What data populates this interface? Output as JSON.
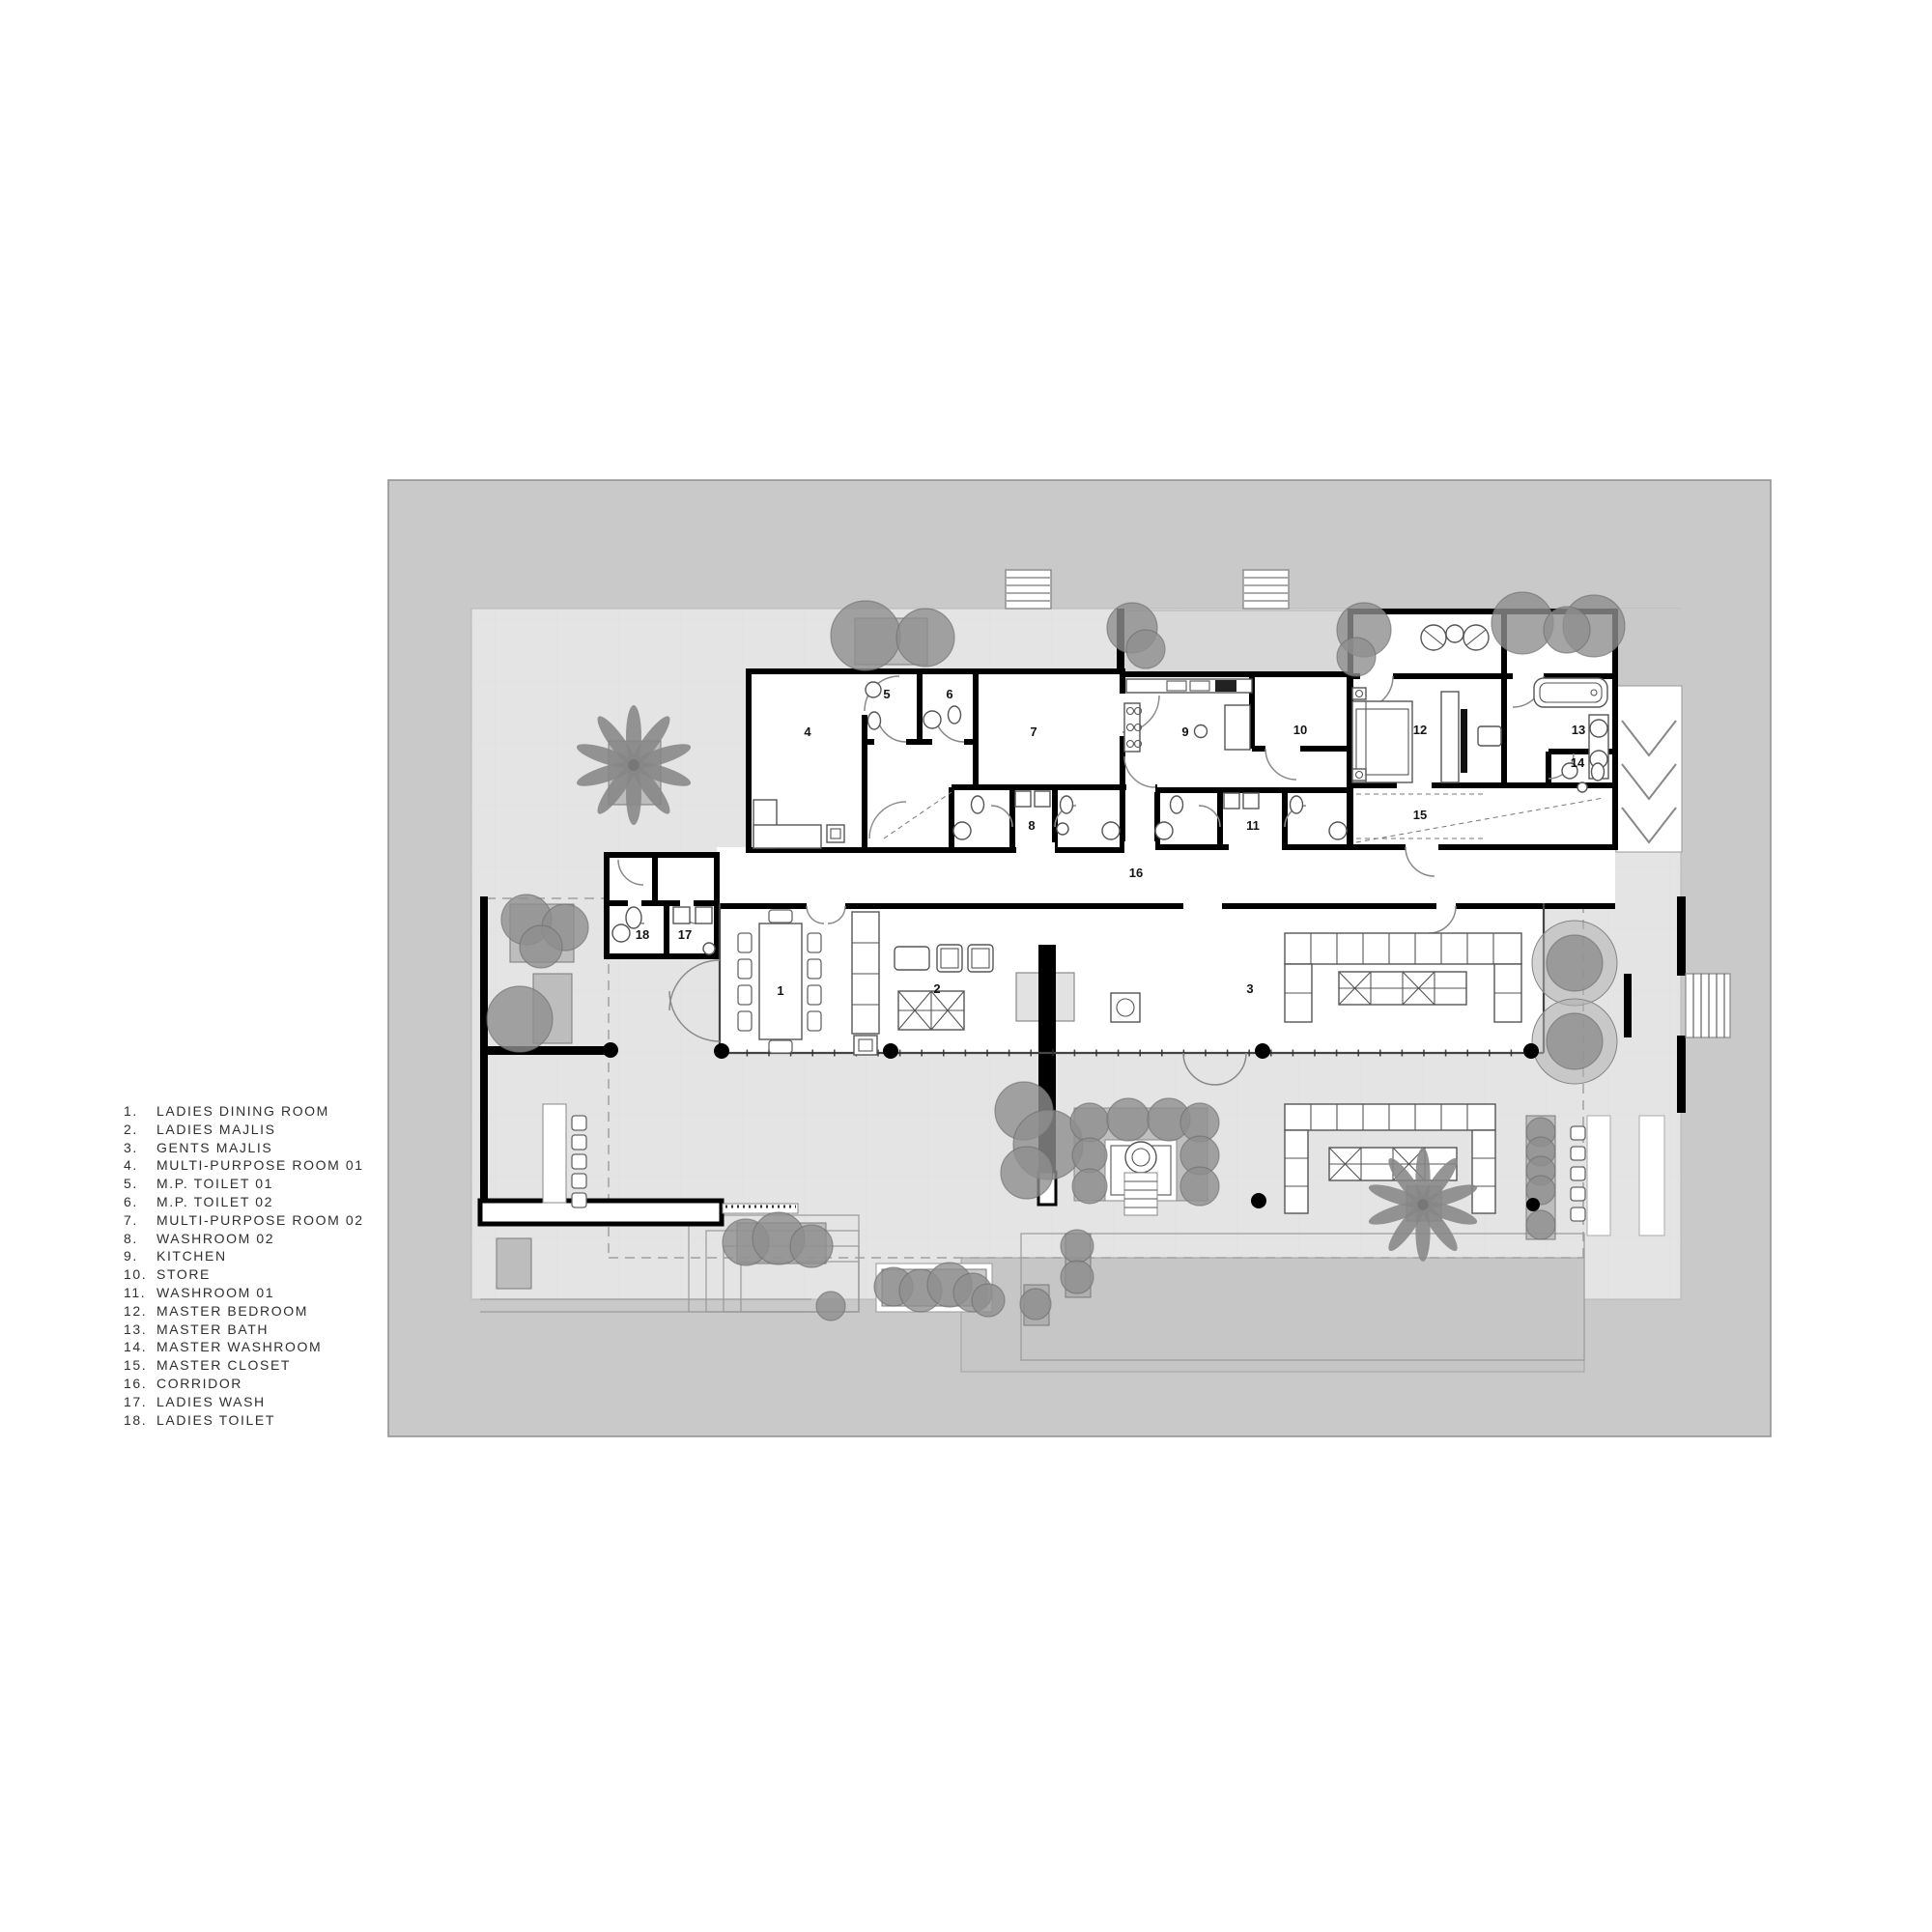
{
  "legend": {
    "items": [
      {
        "num": "1.",
        "label": "LADIES DINING ROOM"
      },
      {
        "num": "2.",
        "label": "LADIES MAJLIS"
      },
      {
        "num": "3.",
        "label": "GENTS MAJLIS"
      },
      {
        "num": "4.",
        "label": "MULTI-PURPOSE ROOM 01"
      },
      {
        "num": "5.",
        "label": "M.P. TOILET 01"
      },
      {
        "num": "6.",
        "label": "M.P. TOILET 02"
      },
      {
        "num": "7.",
        "label": "MULTI-PURPOSE ROOM 02"
      },
      {
        "num": "8.",
        "label": "WASHROOM 02"
      },
      {
        "num": "9.",
        "label": "KITCHEN"
      },
      {
        "num": "10.",
        "label": "STORE"
      },
      {
        "num": "11.",
        "label": "WASHROOM 01"
      },
      {
        "num": "12.",
        "label": "MASTER BEDROOM"
      },
      {
        "num": "13.",
        "label": "MASTER BATH"
      },
      {
        "num": "14.",
        "label": "MASTER WASHROOM"
      },
      {
        "num": "15.",
        "label": "MASTER CLOSET"
      },
      {
        "num": "16.",
        "label": "CORRIDOR"
      },
      {
        "num": "17.",
        "label": "LADIES WASH"
      },
      {
        "num": "18.",
        "label": "LADIES TOILET"
      }
    ]
  },
  "plan": {
    "room_labels": [
      "1",
      "2",
      "3",
      "4",
      "5",
      "6",
      "7",
      "8",
      "9",
      "10",
      "11",
      "12",
      "13",
      "14",
      "15",
      "16",
      "17",
      "18"
    ]
  },
  "colors": {
    "background": "#ffffff",
    "site": "#c9c9c9",
    "terrace": "#e4e4e4",
    "courtyard": "#d8d8d8",
    "platform": "#c6c6c6",
    "wall": "#000000",
    "tree": "#8f8f8f",
    "planter": "#9c9c9c",
    "furniture_line": "#555555",
    "text": "#2f2f2f"
  }
}
